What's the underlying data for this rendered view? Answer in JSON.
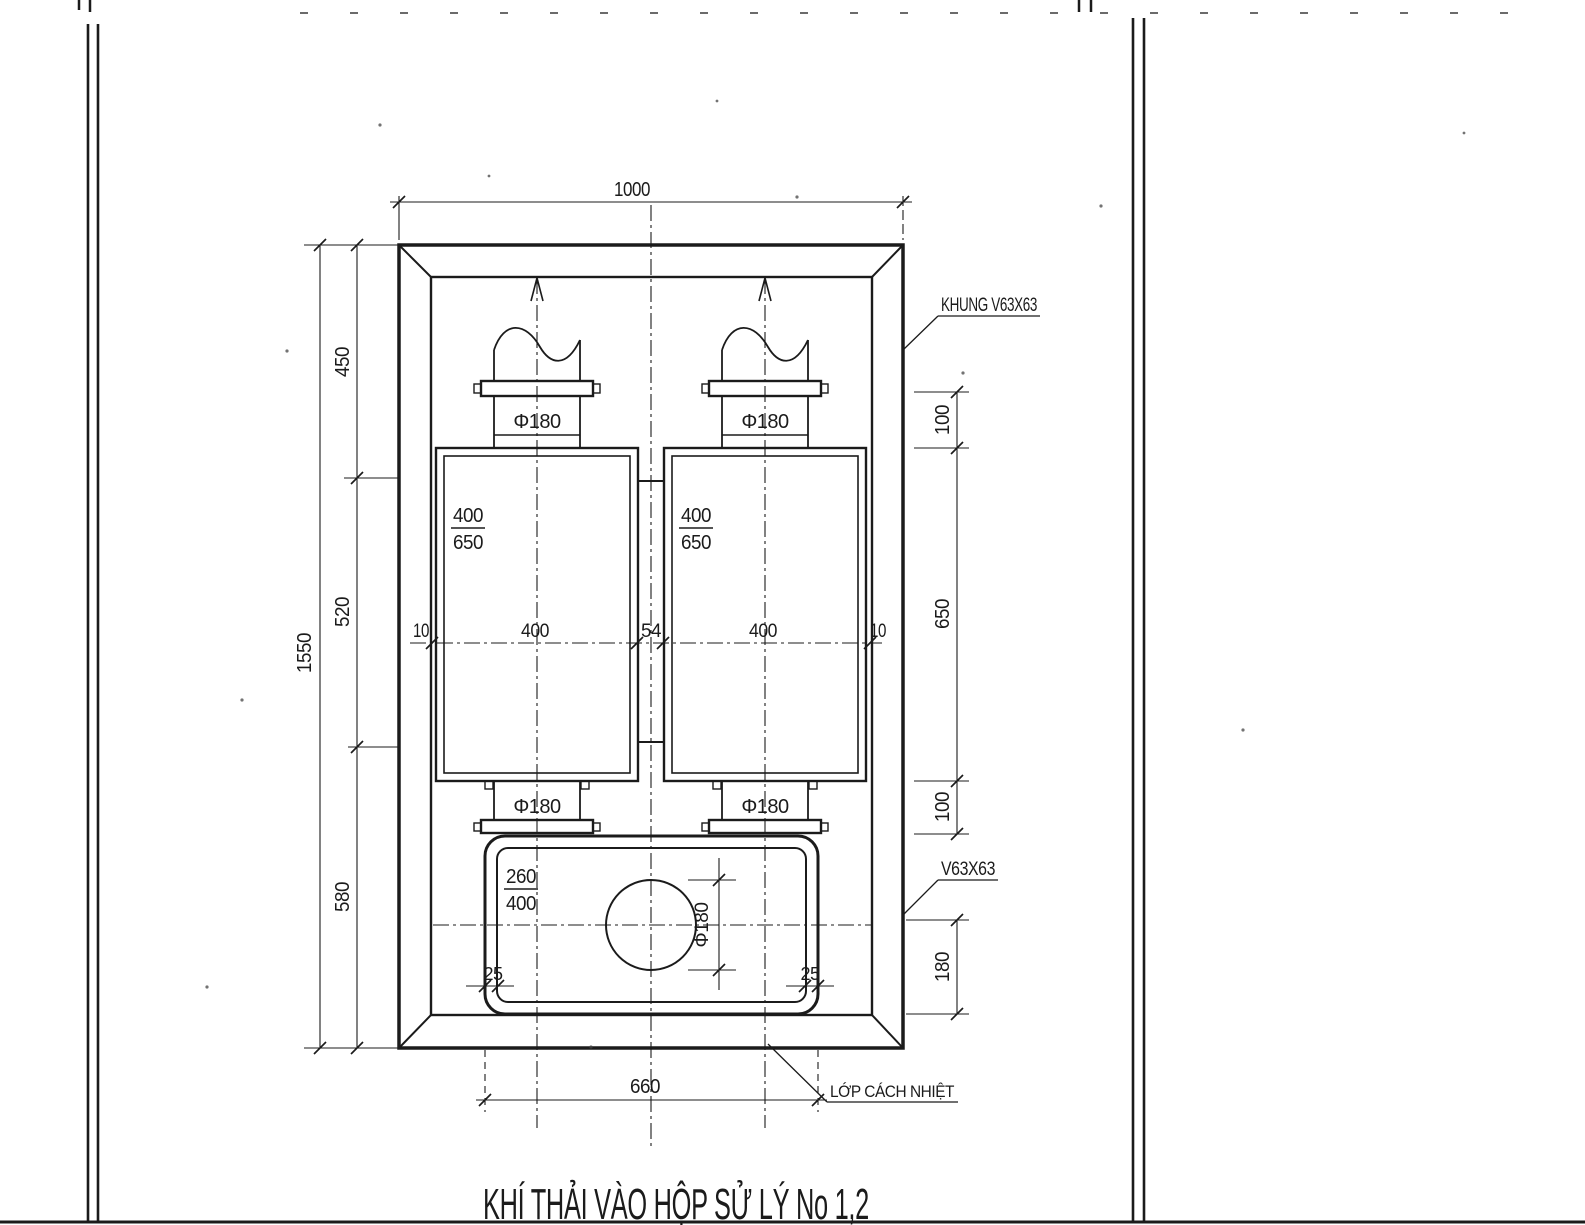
{
  "page": {
    "title": "KHÍ THẢI VÀO HỘP SỬ LÝ No 1,2"
  },
  "callouts": {
    "frame": "KHUNG V63X63",
    "angle_bar": "V63X63",
    "insulation": "LỚP CÁCH NHIỆT"
  },
  "dims": {
    "top_width": "1000",
    "left_overall": "1550",
    "left_segments": [
      "450",
      "520",
      "580"
    ],
    "right_segments": [
      "100",
      "650",
      "100",
      "180"
    ],
    "mid_row": [
      "10",
      "400",
      "54",
      "400",
      "10"
    ],
    "bottom_width": "660",
    "corner_radius": "25",
    "pipe_diameter": "Φ180",
    "chamber_fraction": {
      "num": "400",
      "den": "650"
    },
    "outlet_fraction": {
      "num": "260",
      "den": "400"
    }
  },
  "colors": {
    "ink": "#1b1b1b",
    "paper": "#ffffff"
  }
}
